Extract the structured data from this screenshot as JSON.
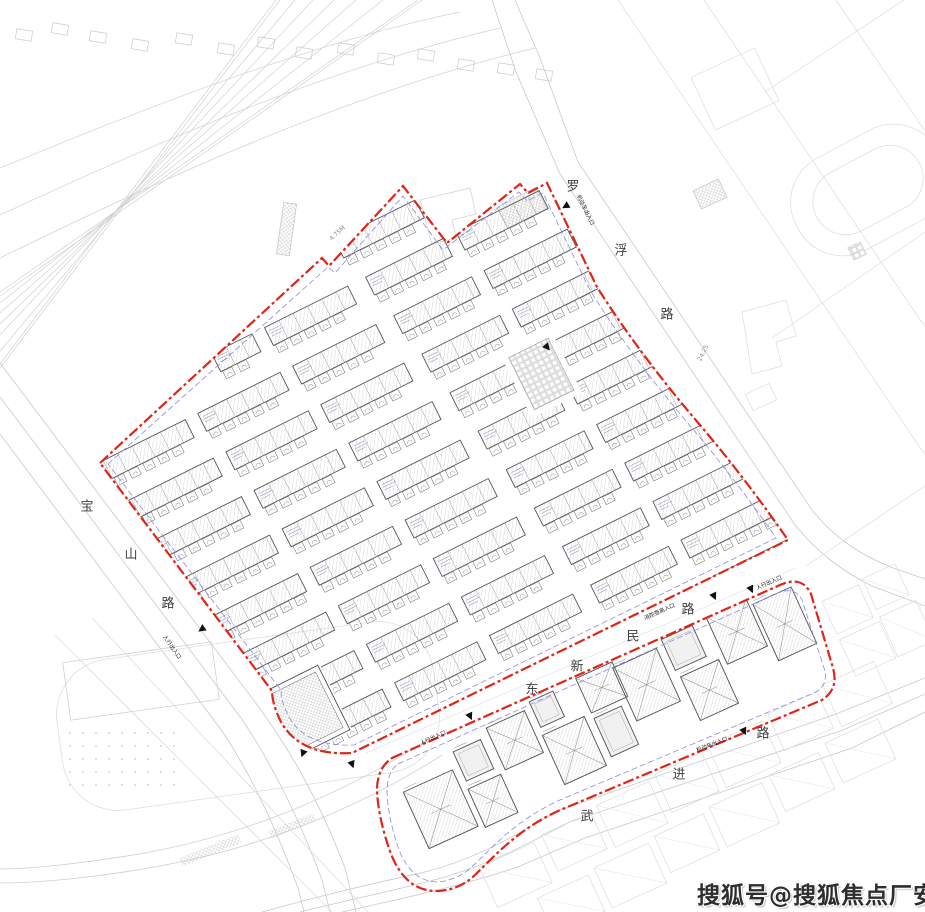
{
  "roads": {
    "luofu": {
      "name": "罗浮路",
      "chars": [
        "罗",
        "浮",
        "路"
      ]
    },
    "baoshan": {
      "name": "宝山路",
      "chars": [
        "宝",
        "山",
        "路"
      ]
    },
    "dongxinmin": {
      "name": "东新民路",
      "chars": [
        "东",
        "新",
        "民",
        "路"
      ]
    },
    "wujin": {
      "name": "武进路",
      "chars": [
        "武",
        "进",
        "路"
      ]
    }
  },
  "entrances": {
    "vehicle": "机动车出入口",
    "pedestrian": "人行出入口",
    "fire": "消防登高入口"
  },
  "dimensions": {
    "d1": "4.75M",
    "d2": "24.25"
  },
  "watermark": {
    "text": "搜狐号@搜狐焦点厂安站"
  },
  "colors": {
    "boundary_red": "#e02418",
    "boundary_blue": "#8a8ade",
    "building_stroke": "#565656",
    "hatch_line": "#bcbcbc",
    "road_line": "#c9c9c9",
    "faint_line": "#dcdcdc",
    "annex_fill": "#fcfcfc",
    "tiny_text_mark": "#97a3bd",
    "marker_black": "#111111"
  }
}
